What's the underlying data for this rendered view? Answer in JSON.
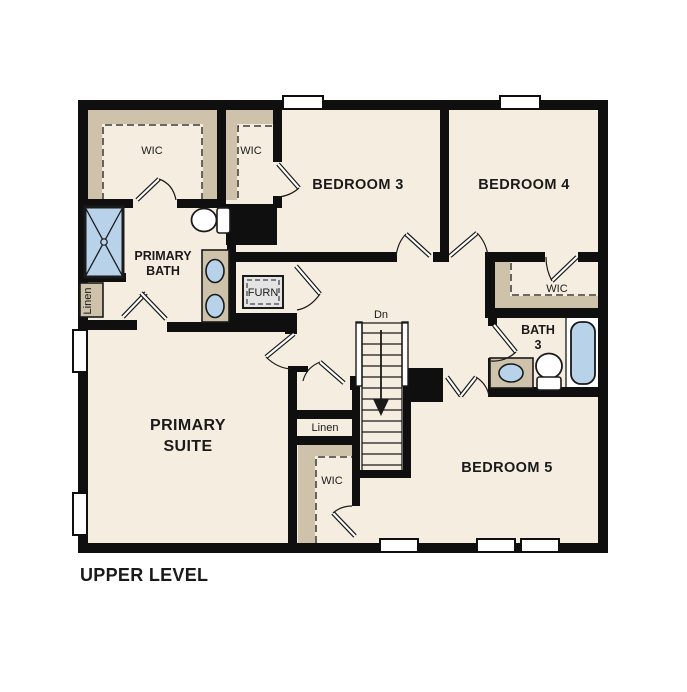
{
  "plan": {
    "title": "UPPER LEVEL",
    "level": "Upper Level floor plan"
  },
  "labels": {
    "upper_level": "UPPER LEVEL",
    "primary_suite_1": "PRIMARY",
    "primary_suite_2": "SUITE",
    "primary_bath_1": "PRIMARY",
    "primary_bath_2": "BATH",
    "bedroom3": "BEDROOM 3",
    "bedroom4": "BEDROOM 4",
    "bedroom5": "BEDROOM 5",
    "bath3_1": "BATH",
    "bath3_2": "3",
    "wic": "WIC",
    "linen": "Linen",
    "furn": "FURN",
    "dn": "Dn"
  },
  "colors": {
    "wall": "#0f0f0f",
    "floor": "#f5eee0",
    "closet_shelving": "#cec3aa",
    "plumbing_blue": "#b8d2ea",
    "furnace_gray": "#e4e4e4",
    "text": "#1a1a1a",
    "background": "#ffffff"
  },
  "rooms": [
    {
      "name": "Primary Suite"
    },
    {
      "name": "Primary Bath"
    },
    {
      "name": "Bedroom 3"
    },
    {
      "name": "Bedroom 4"
    },
    {
      "name": "Bedroom 5"
    },
    {
      "name": "Bath 3"
    },
    {
      "name": "WIC x4"
    },
    {
      "name": "Linen x2"
    },
    {
      "name": "Furnace closet"
    }
  ]
}
